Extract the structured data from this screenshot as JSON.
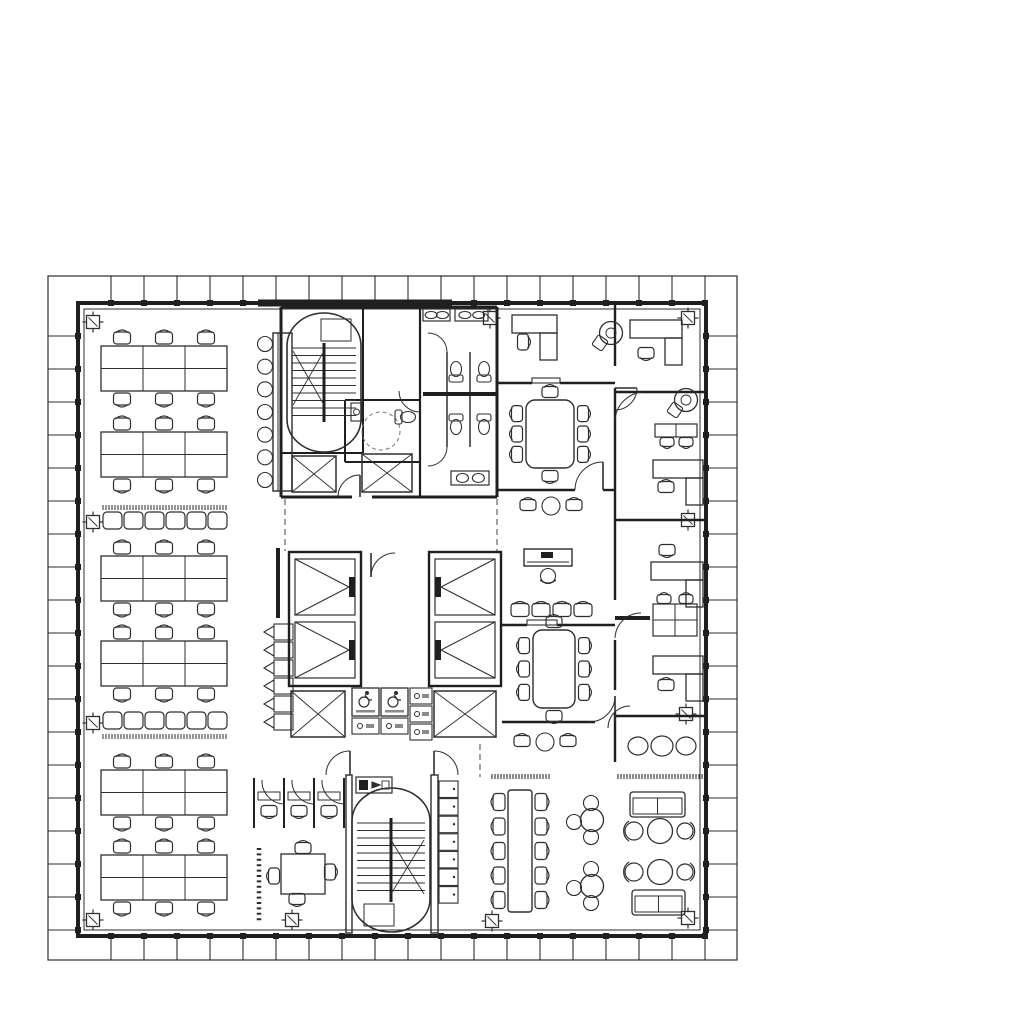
{
  "meta": {
    "canvas": {
      "w": 1024,
      "h": 1013
    },
    "colors": {
      "ink": "#2e2e2e",
      "wall": "#1f1f1f",
      "light": "#8a8a8a",
      "paper": "#ffffff"
    }
  },
  "perimeter": {
    "outer": [
      48,
      276,
      737,
      960
    ],
    "wall": [
      78,
      303,
      706,
      936
    ],
    "glass": [
      84,
      309,
      700,
      930
    ],
    "tick_spacing": 33,
    "dark_top_segment": [
      258,
      303,
      452,
      303
    ]
  },
  "columns": [
    [
      93,
      322
    ],
    [
      490,
      318
    ],
    [
      688,
      318
    ],
    [
      93,
      522
    ],
    [
      688,
      520
    ],
    [
      93,
      723
    ],
    [
      686,
      714
    ],
    [
      93,
      920
    ],
    [
      292,
      920
    ],
    [
      492,
      921
    ],
    [
      688,
      918
    ]
  ],
  "walls": [
    [
      281,
      307,
      497,
      307,
      3
    ],
    [
      281,
      307,
      281,
      497,
      3
    ],
    [
      497,
      307,
      497,
      497,
      3
    ],
    [
      281,
      497,
      352,
      497,
      3
    ],
    [
      372,
      497,
      497,
      497,
      3
    ],
    [
      363,
      307,
      363,
      453,
      2
    ],
    [
      281,
      453,
      363,
      453,
      2
    ],
    [
      420,
      307,
      420,
      497,
      2.2
    ],
    [
      447,
      352,
      447,
      447,
      1.4
    ],
    [
      470,
      352,
      470,
      447,
      1.4
    ],
    [
      423,
      394,
      496,
      394,
      4
    ],
    [
      345,
      400,
      420,
      400,
      2
    ],
    [
      345,
      400,
      345,
      462,
      2
    ],
    [
      345,
      462,
      420,
      462,
      2
    ],
    [
      615,
      305,
      615,
      366,
      2.4
    ],
    [
      615,
      388,
      615,
      600,
      2.4
    ],
    [
      615,
      640,
      615,
      690,
      2.4
    ],
    [
      615,
      712,
      615,
      762,
      2.4
    ],
    [
      497,
      383,
      532,
      383,
      2.4
    ],
    [
      560,
      383,
      615,
      383,
      2.4
    ],
    [
      497,
      490,
      575,
      490,
      2.4
    ],
    [
      603,
      490,
      615,
      490,
      2.4
    ],
    [
      615,
      392,
      706,
      392,
      2.4
    ],
    [
      615,
      520,
      706,
      520,
      2.4
    ],
    [
      615,
      618,
      650,
      618,
      4
    ],
    [
      615,
      716,
      706,
      716,
      2.4
    ],
    [
      502,
      625,
      527,
      625,
      2.4
    ],
    [
      557,
      625,
      615,
      625,
      2.4
    ],
    [
      502,
      722,
      595,
      722,
      2.4
    ],
    [
      254,
      778,
      254,
      828,
      2
    ],
    [
      284,
      778,
      284,
      828,
      2
    ],
    [
      314,
      778,
      314,
      828,
      2
    ],
    [
      344,
      778,
      344,
      828,
      2
    ],
    [
      278,
      548,
      278,
      618,
      4
    ]
  ],
  "dashed_lines": [
    [
      285,
      499,
      285,
      551
    ],
    [
      497,
      499,
      497,
      551
    ],
    [
      480,
      744,
      480,
      777
    ]
  ],
  "dotted_screens": [
    [
      259,
      848,
      259,
      922
    ]
  ],
  "door_arcs": [
    {
      "a": [
        575,
        490,
        603,
        462,
        28,
        1
      ],
      "leaf": [
        603,
        462,
        603,
        490
      ]
    },
    {
      "a": [
        589,
        722,
        615,
        696,
        26,
        0
      ],
      "leaf": [
        615,
        696,
        615,
        722
      ]
    },
    {
      "a": [
        637,
        388,
        615,
        410,
        22,
        1
      ],
      "leaf": [
        615,
        388,
        637,
        388
      ]
    },
    {
      "a": [
        615,
        422,
        645,
        392,
        30,
        1
      ]
    },
    {
      "a": [
        615,
        638,
        641,
        613,
        26,
        1
      ]
    },
    {
      "a": [
        608,
        728,
        630,
        706,
        22,
        1
      ]
    },
    {
      "a": [
        371,
        577,
        395,
        553,
        24,
        1
      ],
      "leaf": [
        371,
        553,
        371,
        577
      ]
    },
    {
      "a": [
        350,
        751,
        326,
        775,
        24,
        0
      ],
      "leaf": [
        350,
        775,
        350,
        751
      ]
    },
    {
      "a": [
        434,
        751,
        458,
        775,
        24,
        1
      ],
      "leaf": [
        434,
        775,
        434,
        751
      ]
    },
    {
      "a": [
        428,
        333,
        447,
        352,
        19,
        1
      ]
    },
    {
      "a": [
        447,
        447,
        428,
        466,
        19,
        1
      ]
    },
    {
      "a": [
        420,
        412,
        399,
        391,
        21,
        1
      ]
    },
    {
      "a": [
        360,
        475,
        338,
        497,
        22,
        0
      ],
      "leaf": [
        360,
        497,
        360,
        475
      ]
    },
    {
      "a": [
        284,
        804,
        262,
        780,
        23,
        1
      ]
    },
    {
      "a": [
        314,
        804,
        292,
        780,
        23,
        1
      ]
    },
    {
      "a": [
        344,
        804,
        322,
        780,
        23,
        1
      ]
    }
  ],
  "wall_openings": [
    [
      532,
      378,
      28,
      5
    ],
    [
      527,
      620,
      30,
      5
    ]
  ],
  "furniture": [
    {
      "type": "bench_desk",
      "x": 101,
      "y": 346
    },
    {
      "type": "bench_desk",
      "x": 101,
      "y": 432
    },
    {
      "type": "bench_desk",
      "x": 101,
      "y": 556
    },
    {
      "type": "bench_desk",
      "x": 101,
      "y": 641
    },
    {
      "type": "bench_desk",
      "x": 101,
      "y": 770
    },
    {
      "type": "bench_desk",
      "x": 101,
      "y": 855
    },
    {
      "type": "bench_row",
      "x": 103,
      "y": 512,
      "comb": "top"
    },
    {
      "type": "bench_row",
      "x": 103,
      "y": 712,
      "comb": "bottom"
    },
    {
      "type": "bar_counter",
      "x": 273,
      "y": 333,
      "h": 158,
      "stools": 7
    },
    {
      "type": "hook_seats",
      "x": 272,
      "y": 624,
      "seats": 6
    },
    {
      "type": "stair",
      "x": 287,
      "y": 313,
      "w": 74,
      "h": 139,
      "cross": "top"
    },
    {
      "type": "shaft",
      "x": 292,
      "y": 456,
      "w": 44,
      "h": 36
    },
    {
      "type": "shaft",
      "x": 362,
      "y": 454,
      "w": 50,
      "h": 38
    },
    {
      "type": "sink_counter",
      "x": 423,
      "y": 309,
      "w": 27,
      "h": 12
    },
    {
      "type": "sink_counter",
      "x": 455,
      "y": 309,
      "w": 33,
      "h": 12
    },
    {
      "type": "sink_counter",
      "x": 451,
      "y": 471,
      "w": 38,
      "h": 14
    },
    {
      "type": "toilet",
      "x": 456,
      "y": 372,
      "rot": 180
    },
    {
      "type": "toilet",
      "x": 484,
      "y": 372,
      "rot": 180
    },
    {
      "type": "toilet",
      "x": 456,
      "y": 424,
      "rot": 0
    },
    {
      "type": "toilet",
      "x": 484,
      "y": 424,
      "rot": 0
    },
    {
      "type": "wc_room",
      "x": 381,
      "y": 431
    },
    {
      "type": "elev_bank",
      "x": 289,
      "y": 552,
      "mirror": false
    },
    {
      "type": "elev_bank",
      "x": 429,
      "y": 552,
      "mirror": true
    },
    {
      "type": "shaft",
      "x": 291,
      "y": 691,
      "w": 54,
      "h": 46
    },
    {
      "type": "shaft",
      "x": 434,
      "y": 691,
      "w": 62,
      "h": 46
    },
    {
      "type": "refuge_block",
      "x": 352,
      "y": 688
    },
    {
      "type": "stair_rails",
      "x": 346,
      "y": 775
    },
    {
      "type": "stair",
      "x": 352,
      "y": 788,
      "w": 78,
      "h": 144,
      "cross": "bottom"
    },
    {
      "type": "lockers",
      "x": 439,
      "y": 781,
      "n": 7
    },
    {
      "type": "l_desk",
      "x": 512,
      "y": 315,
      "bw": 45,
      "chair": [
        524,
        342,
        90
      ]
    },
    {
      "type": "swivel",
      "cx": 611,
      "cy": 333
    },
    {
      "type": "l_desk",
      "x": 630,
      "y": 320,
      "bw": 52,
      "chair": [
        646,
        354,
        180
      ]
    },
    {
      "type": "conf_table",
      "x": 526,
      "y": 400,
      "w": 48,
      "h": 68
    },
    {
      "type": "trio",
      "x": 522,
      "y": 498
    },
    {
      "type": "swivel",
      "cx": 686,
      "cy": 400
    },
    {
      "type": "two_table",
      "x": 655,
      "y": 424
    },
    {
      "type": "l_desk",
      "x": 653,
      "y": 460,
      "bw": 50,
      "chair": [
        666,
        486,
        0
      ]
    },
    {
      "type": "reception",
      "x": 524,
      "y": 549
    },
    {
      "type": "chair_row",
      "x": 512,
      "y": 601,
      "n": 4,
      "step": 21
    },
    {
      "type": "conf_table",
      "x": 533,
      "y": 630,
      "w": 42,
      "h": 78
    },
    {
      "type": "trio",
      "x": 516,
      "y": 734
    },
    {
      "type": "circle_trio",
      "x": 638,
      "y": 746
    },
    {
      "type": "l_desk",
      "x": 651,
      "y": 562,
      "bw": 52,
      "chair": [
        667,
        551,
        180
      ]
    },
    {
      "type": "grid_tables",
      "x": 653,
      "y": 604
    },
    {
      "type": "l_desk",
      "x": 653,
      "y": 656,
      "bw": 50,
      "chair": [
        666,
        684,
        0
      ]
    },
    {
      "type": "booths",
      "x": 254,
      "y": 778
    },
    {
      "type": "square_table",
      "x": 279,
      "y": 852
    },
    {
      "type": "long_table",
      "x": 508,
      "y": 790,
      "h": 122,
      "chairs": 5
    },
    {
      "type": "cafe_set",
      "cx": 592,
      "cy": 820
    },
    {
      "type": "cafe_set",
      "cx": 592,
      "cy": 886
    },
    {
      "type": "sofa",
      "x": 630,
      "y": 792,
      "w": 55,
      "h": 25
    },
    {
      "type": "lounge_trio",
      "cx": 660,
      "cy": 831
    },
    {
      "type": "lounge_trio",
      "cx": 660,
      "cy": 872
    },
    {
      "type": "sofa",
      "x": 632,
      "y": 890,
      "w": 53,
      "h": 25
    },
    {
      "type": "comb",
      "x": 492,
      "y": 774,
      "len": 58
    },
    {
      "type": "comb",
      "x": 618,
      "y": 774,
      "len": 84
    }
  ]
}
